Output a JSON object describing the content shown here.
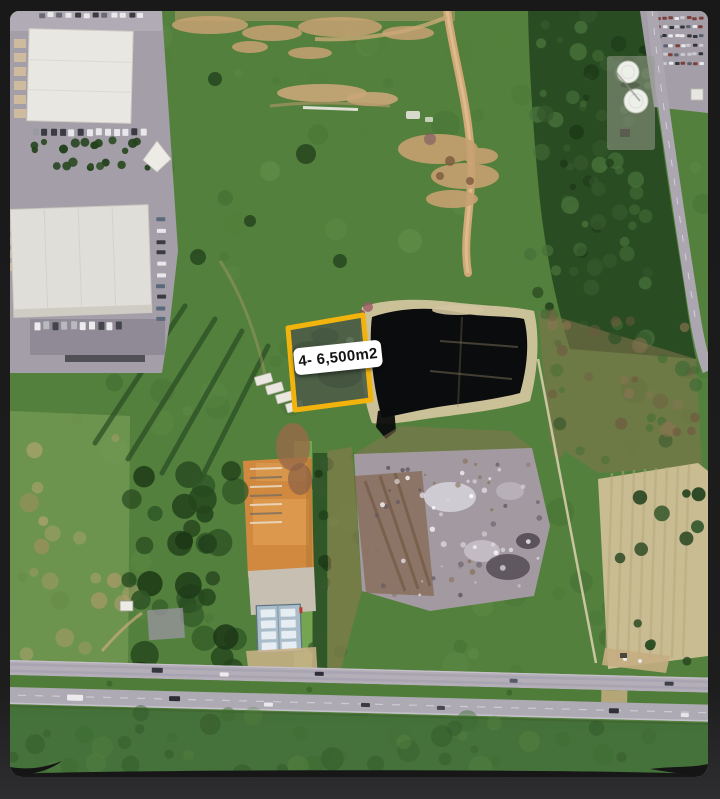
{
  "image": {
    "kind": "aerial-satellite-photo",
    "annotation": {
      "parcel_label": "4- 6,500m2"
    },
    "colors": {
      "frame": "#19191A",
      "frame_edge": "#2E2E30",
      "parcel_outline": "#F2B40C",
      "label_bg": "#FFFFFF",
      "label_text": "#141414",
      "pond": "#0B0C0D",
      "grass": "#53803C",
      "forest": "#2A4C23",
      "dirt_road": "#C9A575",
      "orange_soil": "#D0893E",
      "blue_roof": "#A9BDCB",
      "asphalt": "#A49EA8",
      "building": "#E9E7E1",
      "highway": "#B3AEB7",
      "sand": "#D2C49E",
      "rubble": "#A39AA1",
      "pale_field": "#C9BC92"
    }
  }
}
